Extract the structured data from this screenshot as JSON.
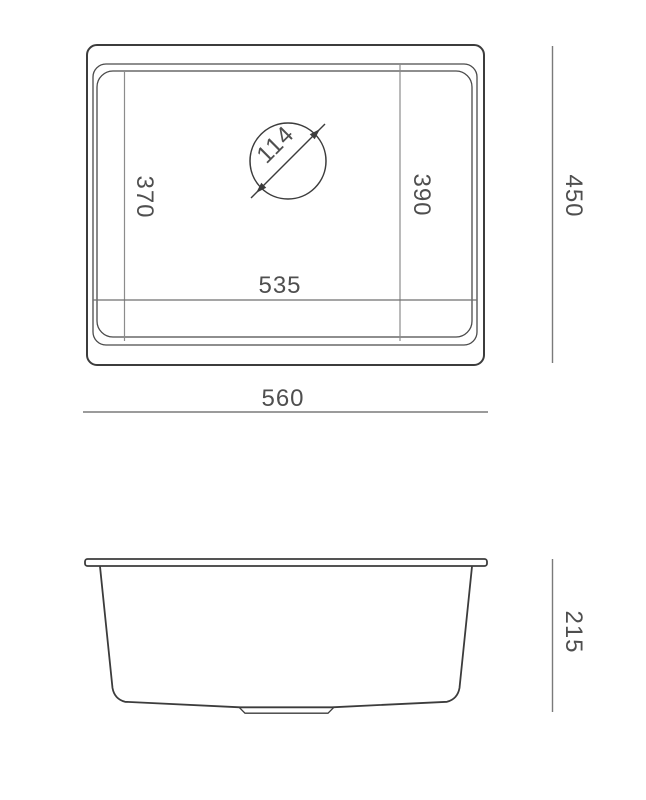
{
  "drawing": {
    "type": "sink-technical-drawing",
    "units": "mm",
    "colors": {
      "outline": "#3c3c3c",
      "dimension_line": "#8c8c8c",
      "text": "#4f4f4f",
      "background": "#ffffff"
    },
    "dims": {
      "drain_diameter": "114",
      "bowl_length_left": "370",
      "bowl_length_right": "390",
      "bowl_width": "535",
      "overall_width": "560",
      "overall_depth": "450",
      "bowl_height": "215"
    }
  }
}
